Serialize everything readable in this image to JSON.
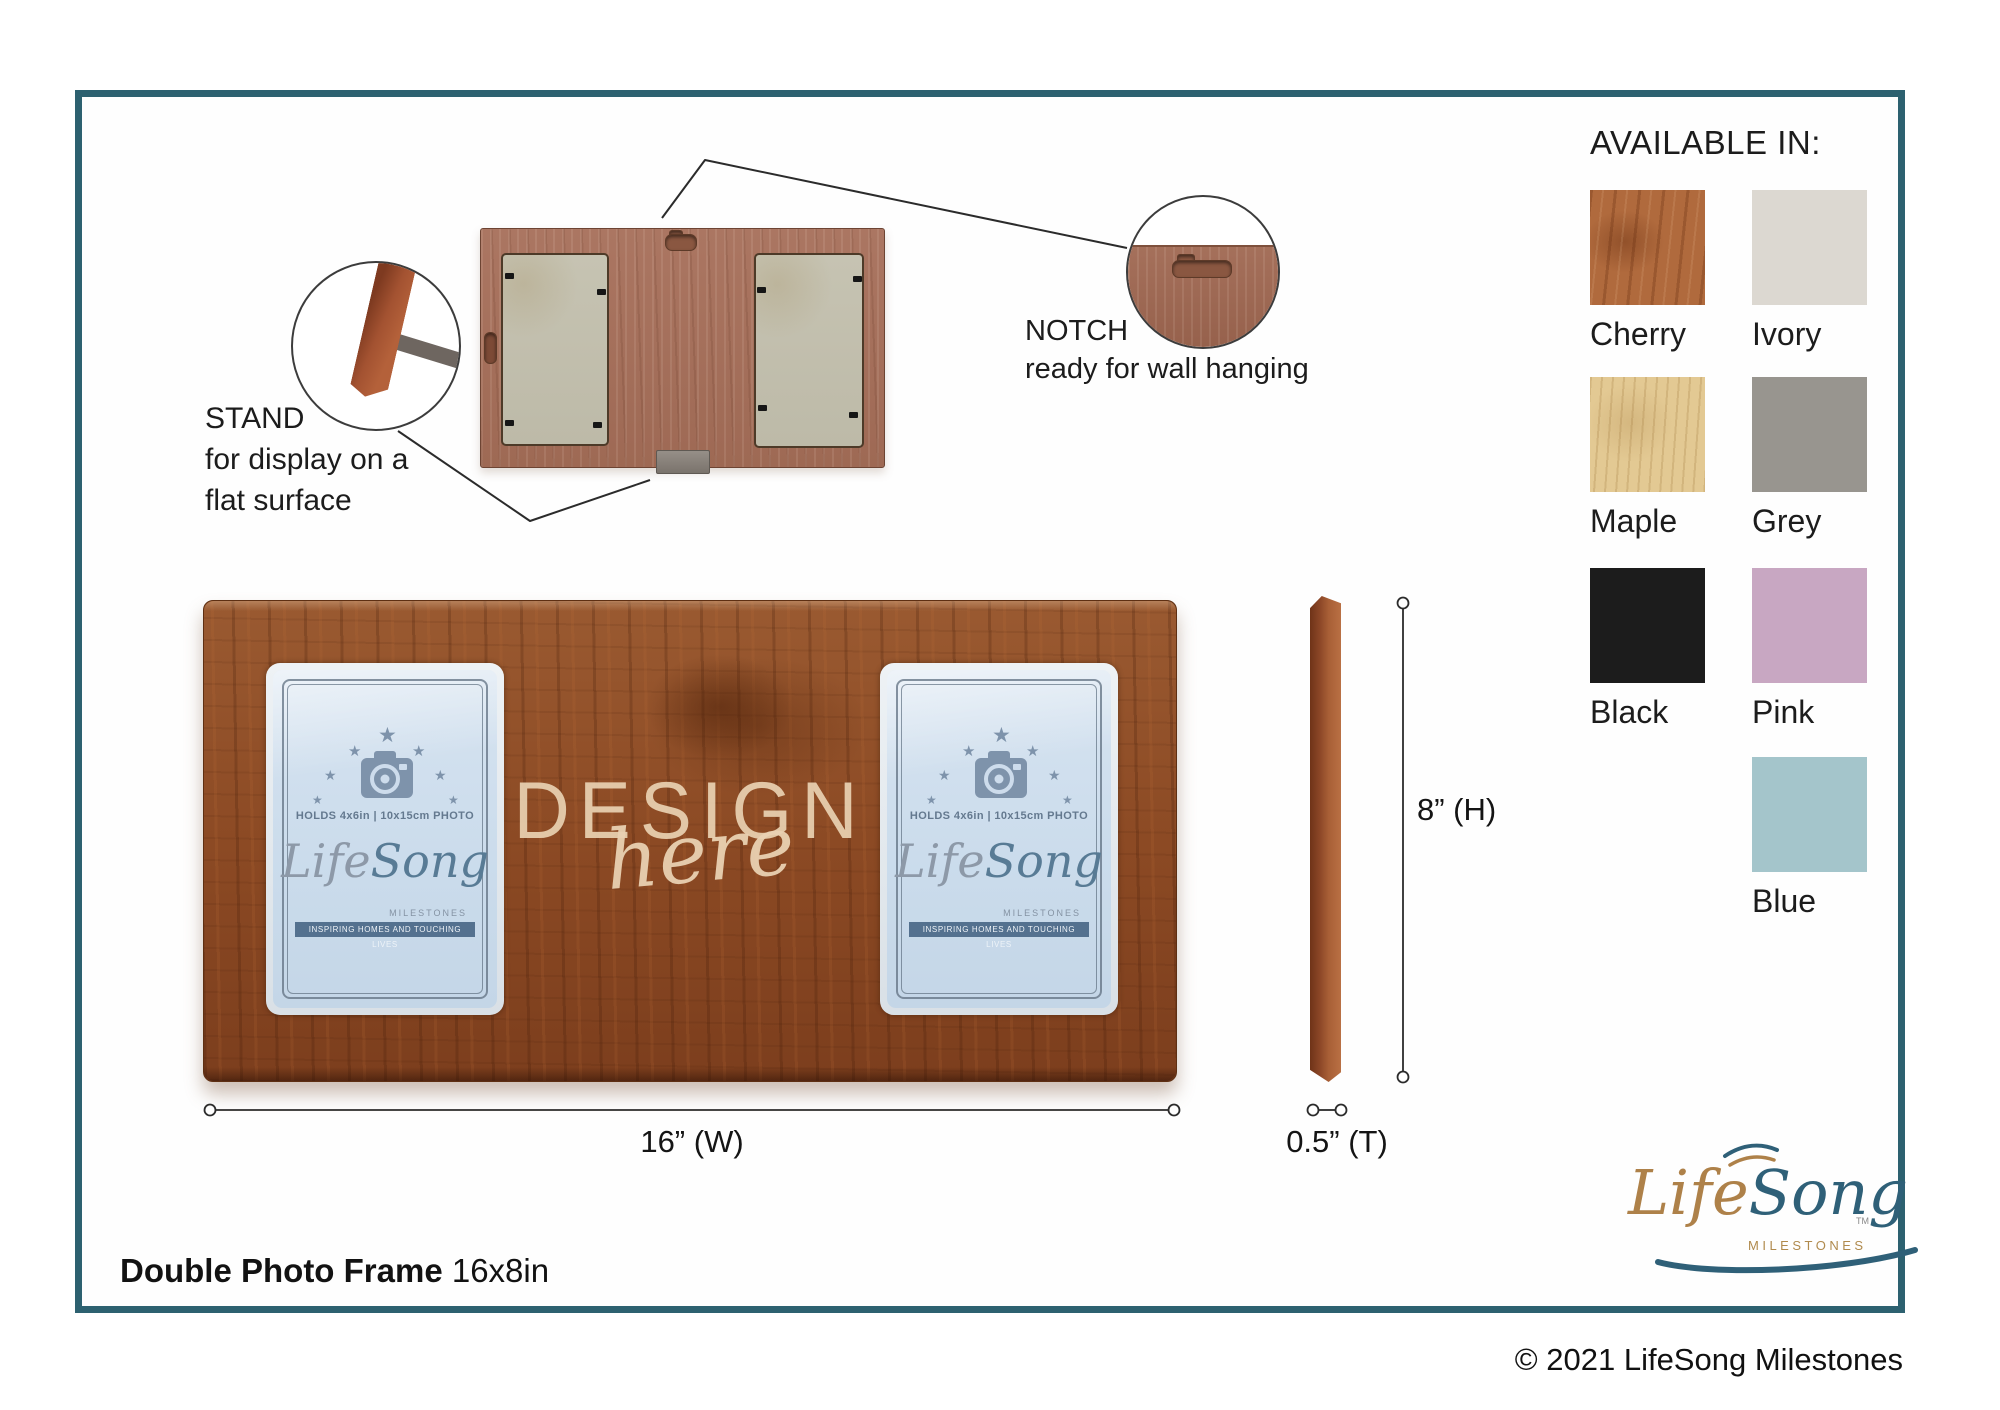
{
  "available_in": {
    "heading": "AVAILABLE IN:",
    "options": [
      {
        "label": "Cherry",
        "color": "#b06a3d"
      },
      {
        "label": "Ivory",
        "color": "#dcd8d1"
      },
      {
        "label": "Maple",
        "color": "#e3c993"
      },
      {
        "label": "Grey",
        "color": "#98958f"
      },
      {
        "label": "Black",
        "color": "#1c1c1c"
      },
      {
        "label": "Pink",
        "color": "#c8a7c2"
      },
      {
        "label": "Blue",
        "color": "#a4c5cb"
      }
    ]
  },
  "callouts": {
    "stand": {
      "title": "STAND",
      "desc1": "for display on a",
      "desc2": "flat surface"
    },
    "notch": {
      "title": "NOTCH",
      "desc": "ready for wall hanging"
    }
  },
  "dimensions": {
    "width": "16” (W)",
    "height": "8” (H)",
    "thickness": "0.5” (T)"
  },
  "watermark": {
    "line1": "DESIGN",
    "line2": "here"
  },
  "placeholder": {
    "holds": "HOLDS 4x6in | 10x15cm PHOTO",
    "brand_life": "Life",
    "brand_song": "Song",
    "brand_sub": "MILESTONES",
    "banner": "INSPIRING HOMES AND TOUCHING LIVES"
  },
  "footer": {
    "title": "Double Photo Frame",
    "size": " 16x8in",
    "copyright": "© 2021 LifeSong Milestones"
  },
  "logo": {
    "life": "Life",
    "song": "Song",
    "sub": "MILESTONES",
    "tm": "TM"
  },
  "colors": {
    "border_teal": "#2d6170",
    "logo_tan": "#ae8149",
    "logo_teal": "#2f6078"
  }
}
